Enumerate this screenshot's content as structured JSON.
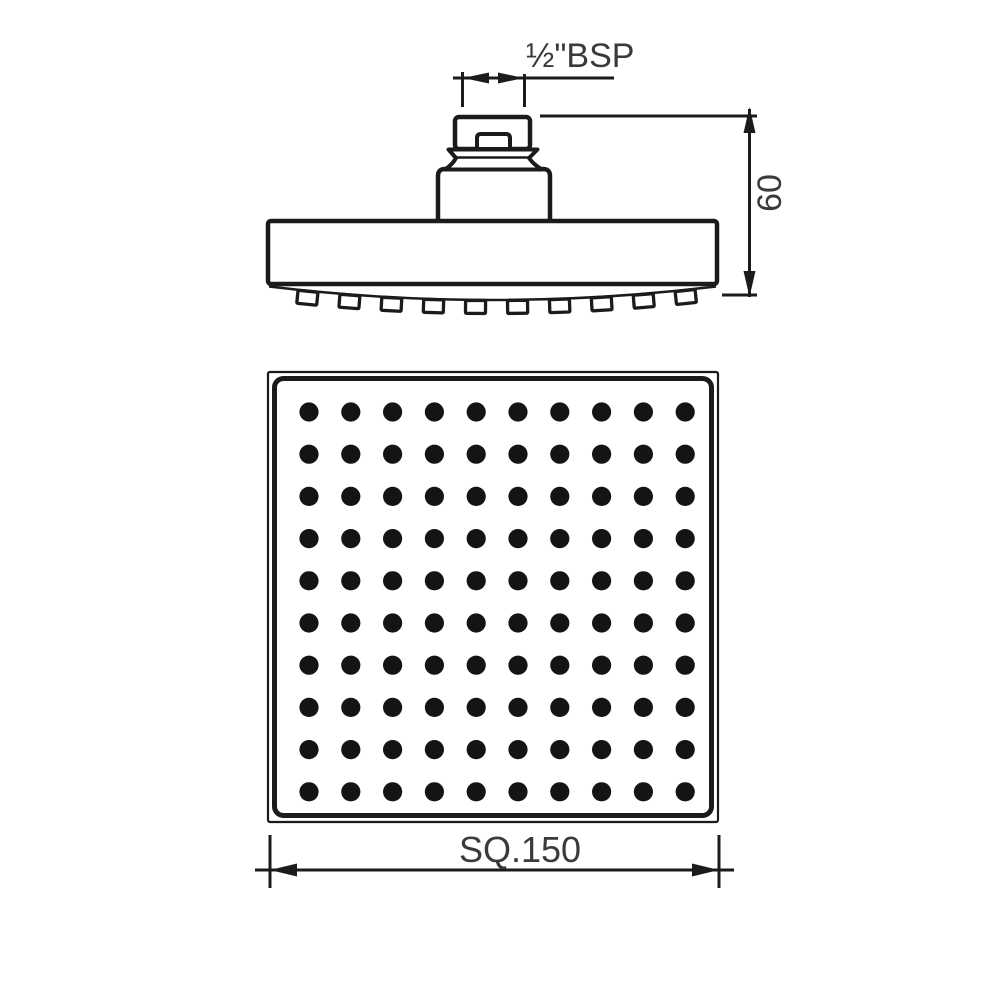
{
  "dimensions": {
    "thread_label": "½\"BSP",
    "height_label": "60",
    "width_label": "SQ.150"
  },
  "nozzle_grid": {
    "rows": 10,
    "cols": 10,
    "side_view_nozzles": 10
  },
  "colors": {
    "line": "#1b1b1b",
    "text": "#3a3a3a",
    "nozzle_dot": "#141414",
    "background": "#ffffff"
  }
}
